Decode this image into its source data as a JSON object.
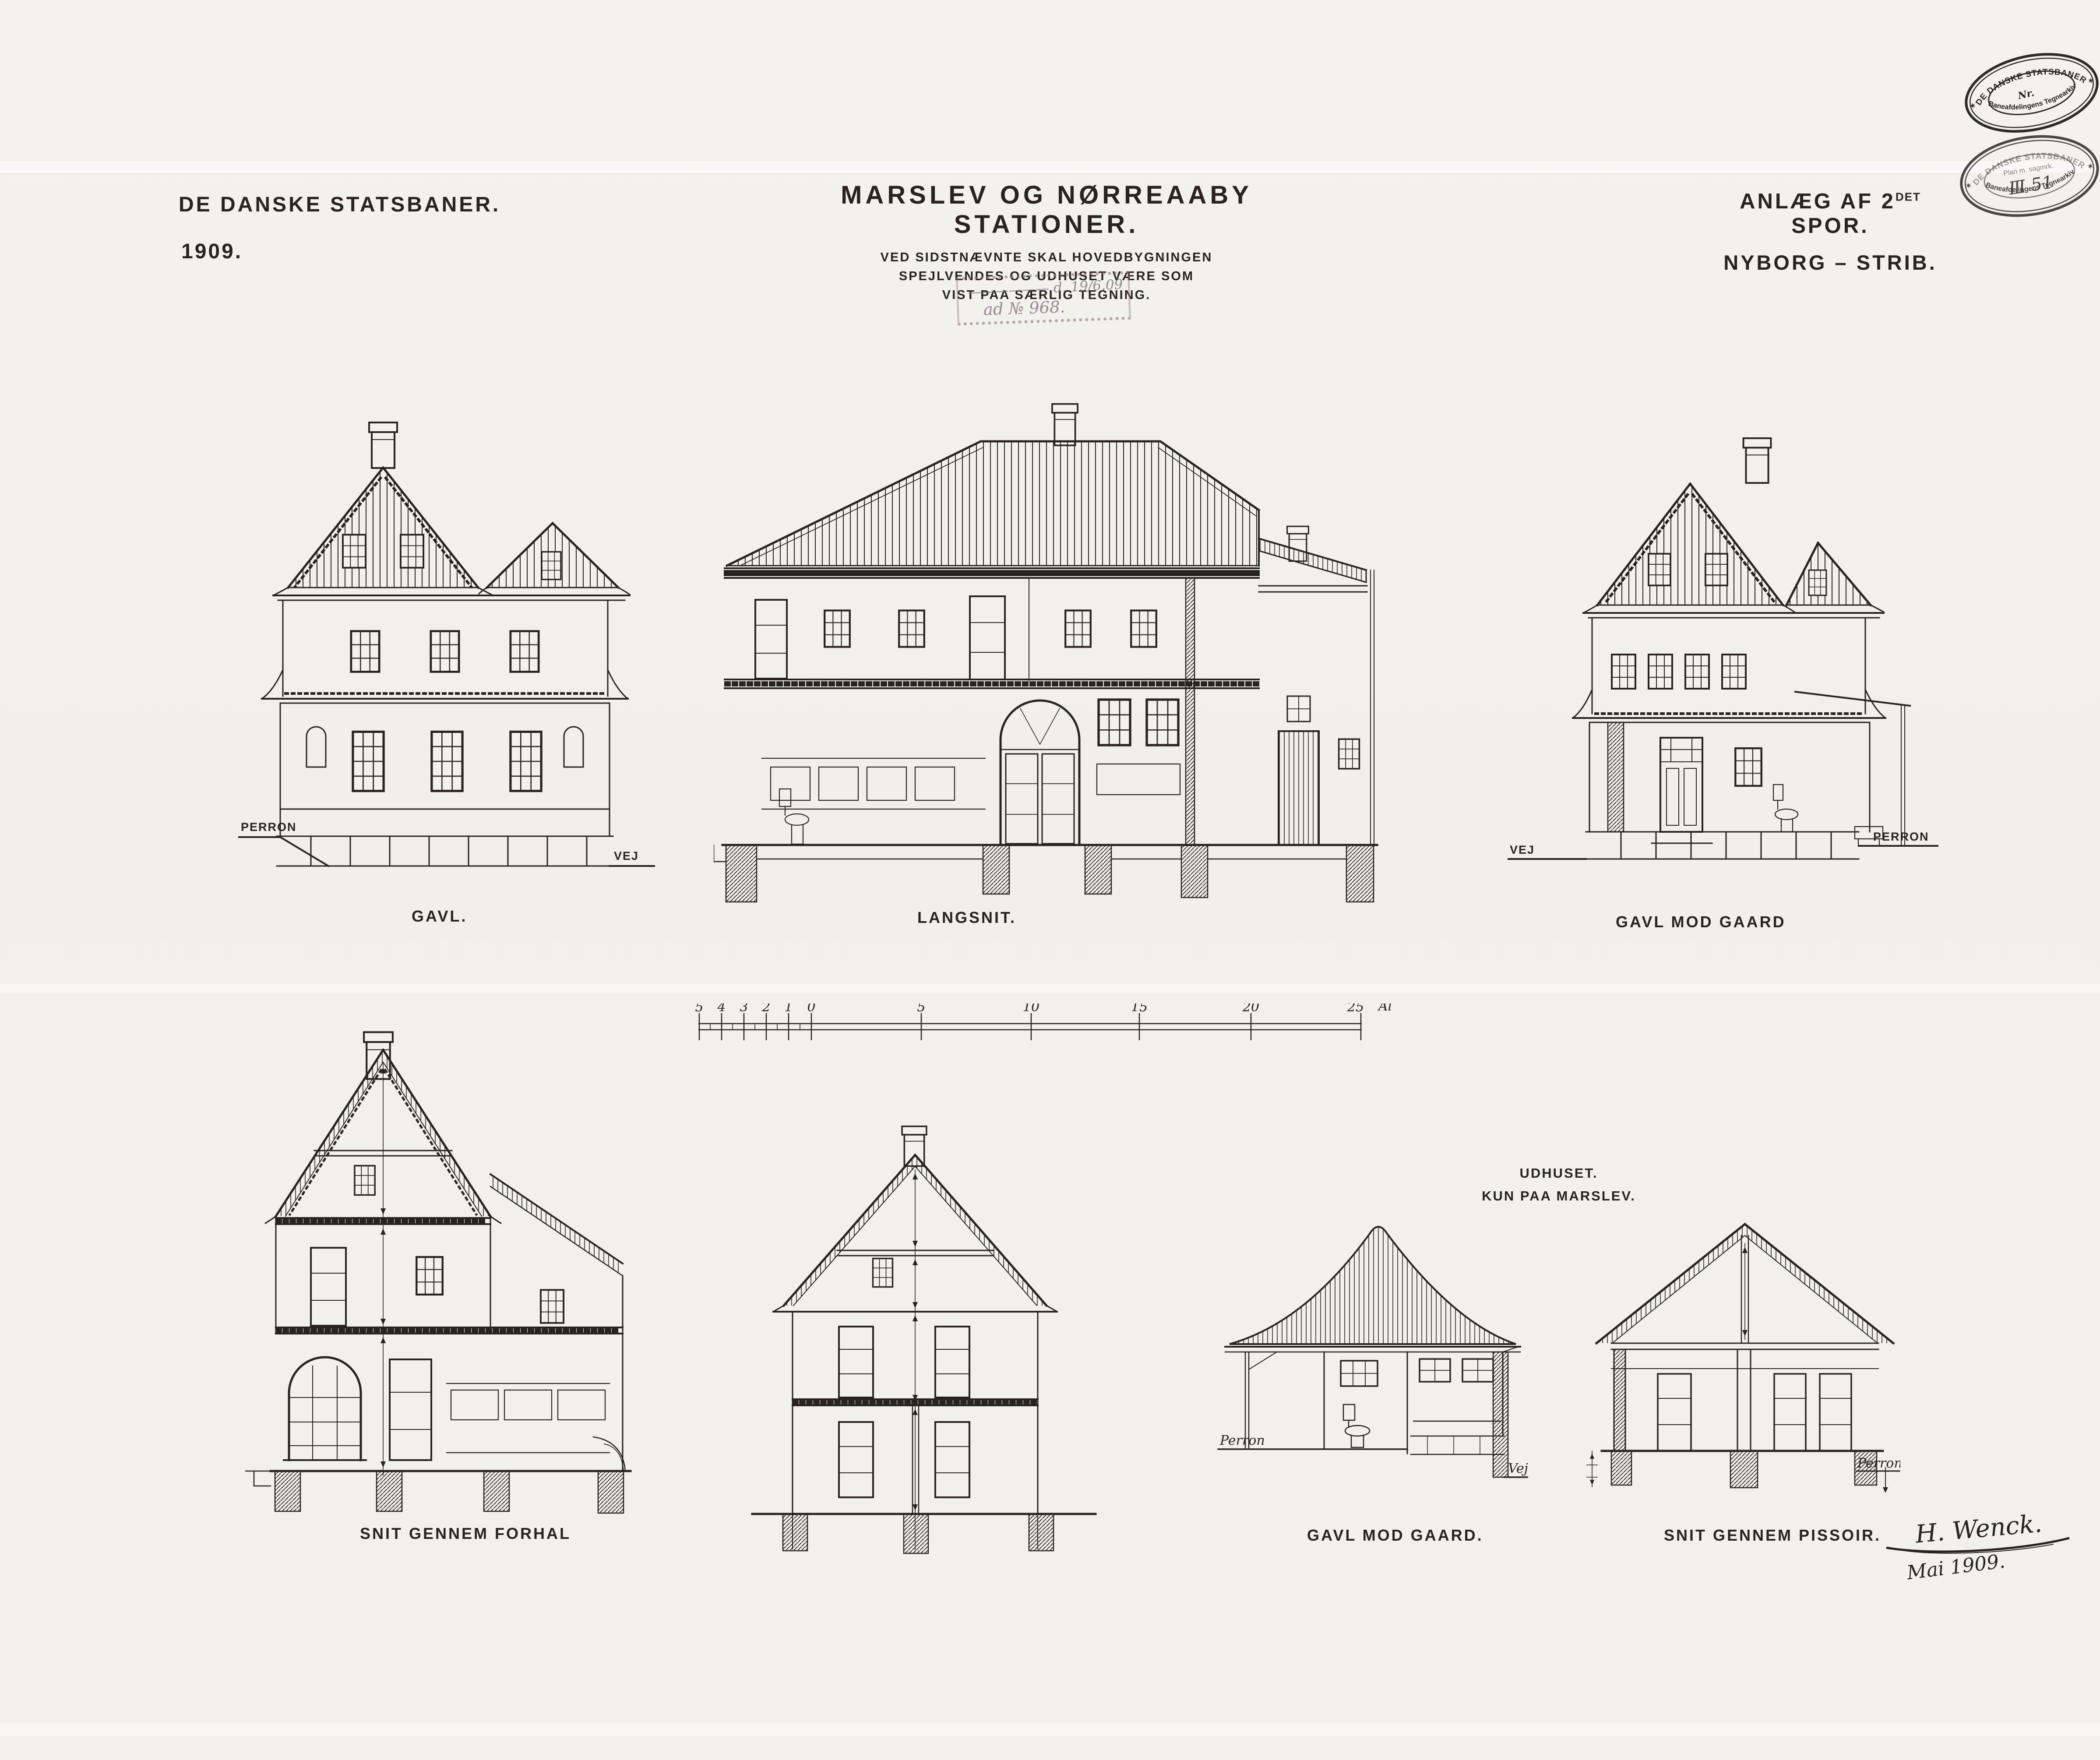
{
  "sheet": {
    "paper_color": "#f3f1ec",
    "ink_color": "#28231e",
    "stamp_red": "#92767c"
  },
  "titles": {
    "company": "DE DANSKE STATSBANER.",
    "year": "1909.",
    "main_title": "MARSLEV OG NØRREAABY STATIONER.",
    "subtitle_line1": "VED SIDSTNÆVNTE SKAL HOVEDBYGNINGEN",
    "subtitle_line2": "SPEJLVENDES OG UDHUSET VÆRE SOM",
    "subtitle_line3": "VIST PAA SÆRLIG TEGNING.",
    "project_line1_prefix": "ANLÆG AF 2",
    "project_line1_sup": "DET",
    "project_line1_suffix": " SPOR.",
    "project_line2": "NYBORG – STRIB."
  },
  "stamps": {
    "archive_stamp_1": {
      "arc_top": "DE DANSKE STATSBANER",
      "center": "Nr.",
      "arc_bottom": "Baneafdelingens Tegnearkiv",
      "star_left": "✶",
      "star_right": "✶"
    },
    "archive_stamp_2": {
      "arc_top": "DE DANSKE STATSBANER",
      "center_line1": "Plan m. sagmrk.",
      "center_line2": "Ⅲ 51",
      "arc_bottom": "Baneafdelingens Tegnearkiv",
      "star_left": "✶",
      "star_right": "✶"
    },
    "journal_stamp": {
      "line1": "—————— d. 19/6.09",
      "line2": "ad № 968."
    }
  },
  "figures": {
    "gavl": {
      "caption": "GAVL.",
      "label_left": "PERRON",
      "label_right": "VEJ"
    },
    "langsnit": {
      "caption": "LANGSNIT."
    },
    "gavl_mod_gaard": {
      "caption": "GAVL MOD GAARD",
      "label_left": "VEJ",
      "label_right": "PERRON"
    },
    "snit_gennem_forhal": {
      "caption": "SNIT GENNEM FORHAL"
    },
    "udhus": {
      "heading_line1": "UDHUSET.",
      "heading_line2": "KUN PAA MARSLEV."
    },
    "udhus_gavl": {
      "caption": "GAVL MOD GAARD.",
      "label_left": "Perron",
      "label_right": "Vej"
    },
    "udhus_snit": {
      "caption": "SNIT GENNEM PISSOIR.",
      "label_right": "Perron"
    }
  },
  "scalebar": {
    "minor_ticks": [
      "5",
      "4",
      "3",
      "2",
      "1",
      "0"
    ],
    "major_ticks": [
      "5",
      "10",
      "15",
      "20"
    ],
    "end_tick": "25",
    "unit": "Alen"
  },
  "signature": {
    "name": "H. Wenck.",
    "date": "Mai 1909."
  }
}
